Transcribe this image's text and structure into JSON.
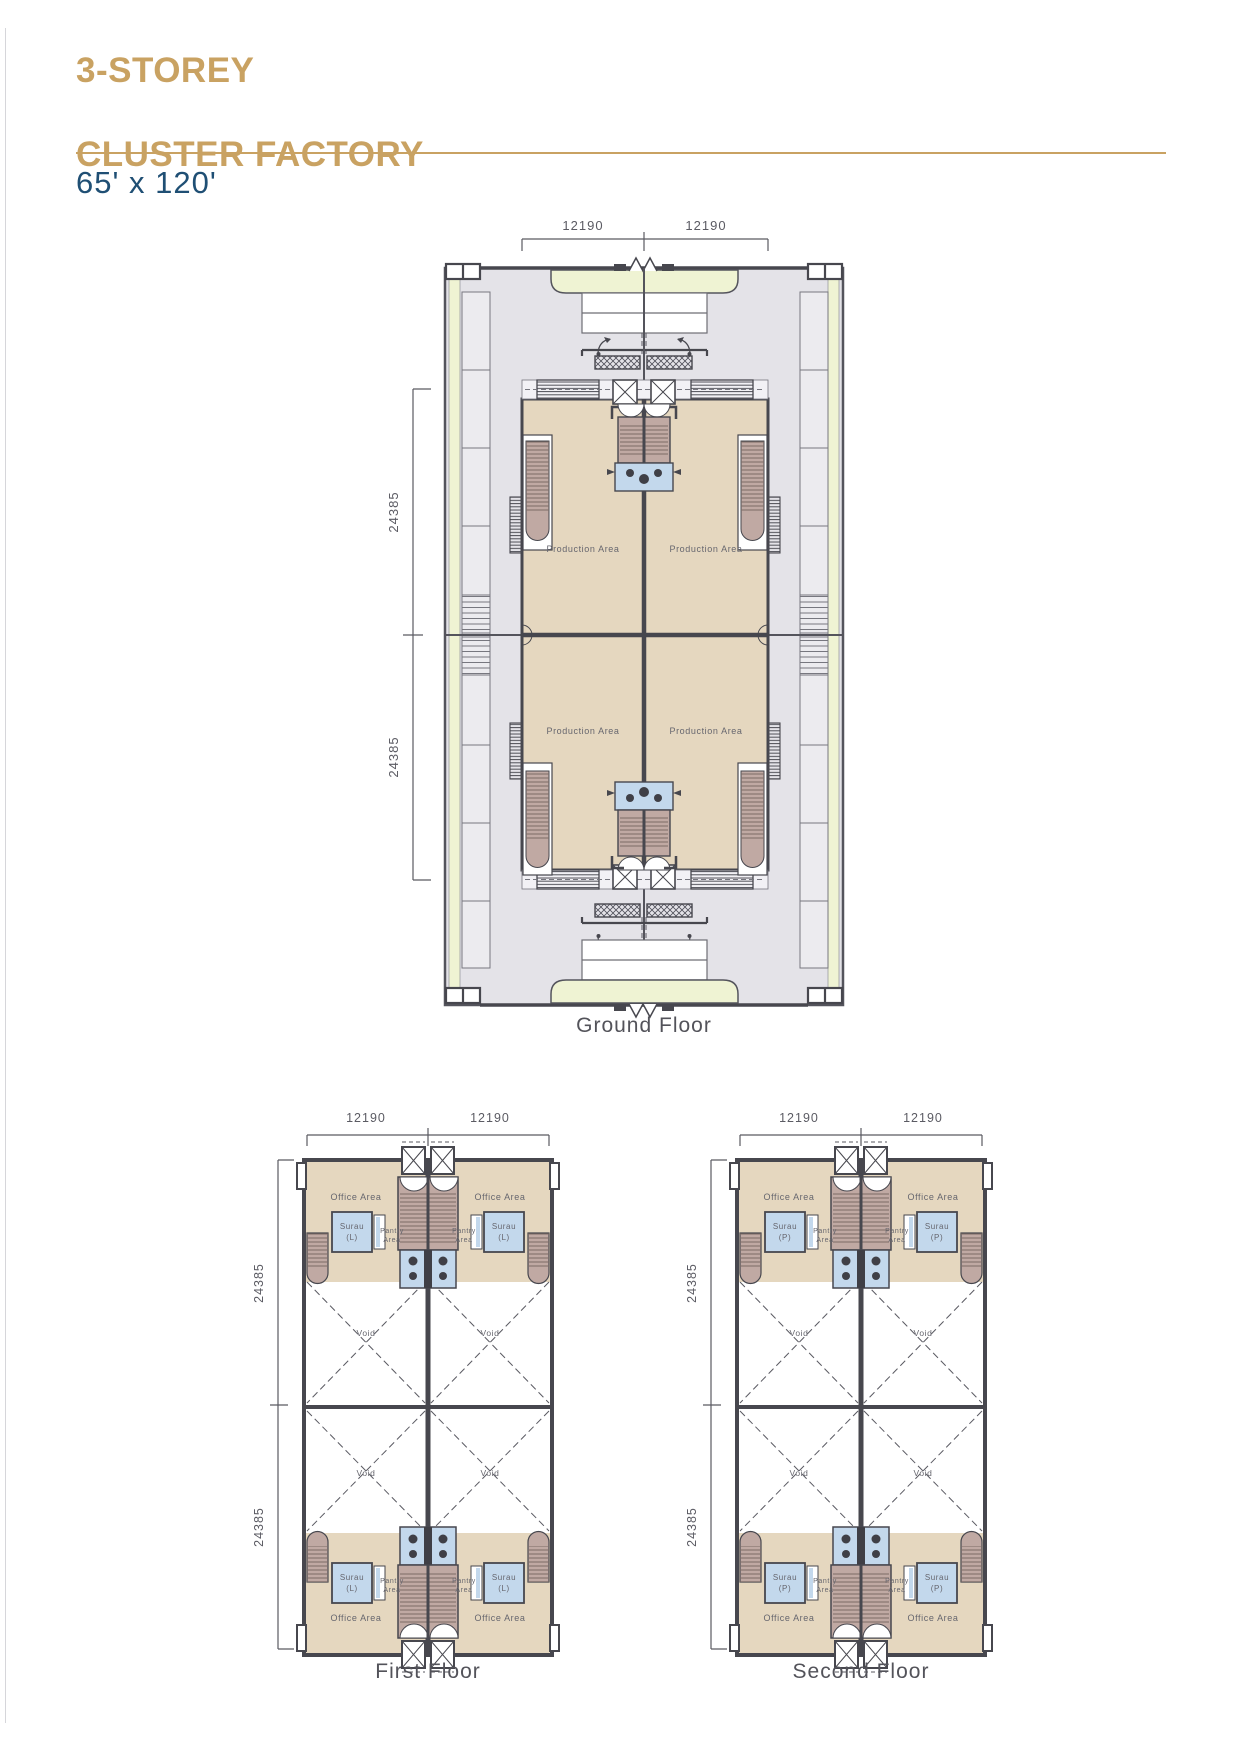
{
  "header": {
    "title_line1": "3-STOREY",
    "title_line2": "CLUSTER FACTORY",
    "size": "65' x 120'"
  },
  "colors": {
    "accent_gold": "#c9a262",
    "heading_navy": "#1f4f74",
    "apron_gray": "#e4e3e8",
    "driveway_yellow": "#eff3d3",
    "floor_beige": "#e5d7bf",
    "stair_brown": "#c0a9a3",
    "washroom_blue": "#c3d8ec",
    "wall_dark": "#47474e"
  },
  "plans": {
    "ground": {
      "caption": "Ground Floor",
      "dim_top": [
        "12190",
        "12190"
      ],
      "dim_left": [
        "24385",
        "24385"
      ],
      "production_label": "Production Area"
    },
    "first": {
      "caption": "First Floor",
      "dim_top": [
        "12190",
        "12190"
      ],
      "dim_left": [
        "24385",
        "24385"
      ],
      "office_label": "Office Area",
      "surau_label": "Surau",
      "surau_sub": "(L)",
      "pantry_line1": "Pantry",
      "pantry_line2": "Area",
      "void_label": "Void"
    },
    "second": {
      "caption": "Second Floor",
      "dim_top": [
        "12190",
        "12190"
      ],
      "dim_left": [
        "24385",
        "24385"
      ],
      "office_label": "Office Area",
      "surau_label": "Surau",
      "surau_sub": "(P)",
      "pantry_line1": "Pantry",
      "pantry_line2": "Area",
      "void_label": "Void"
    }
  }
}
